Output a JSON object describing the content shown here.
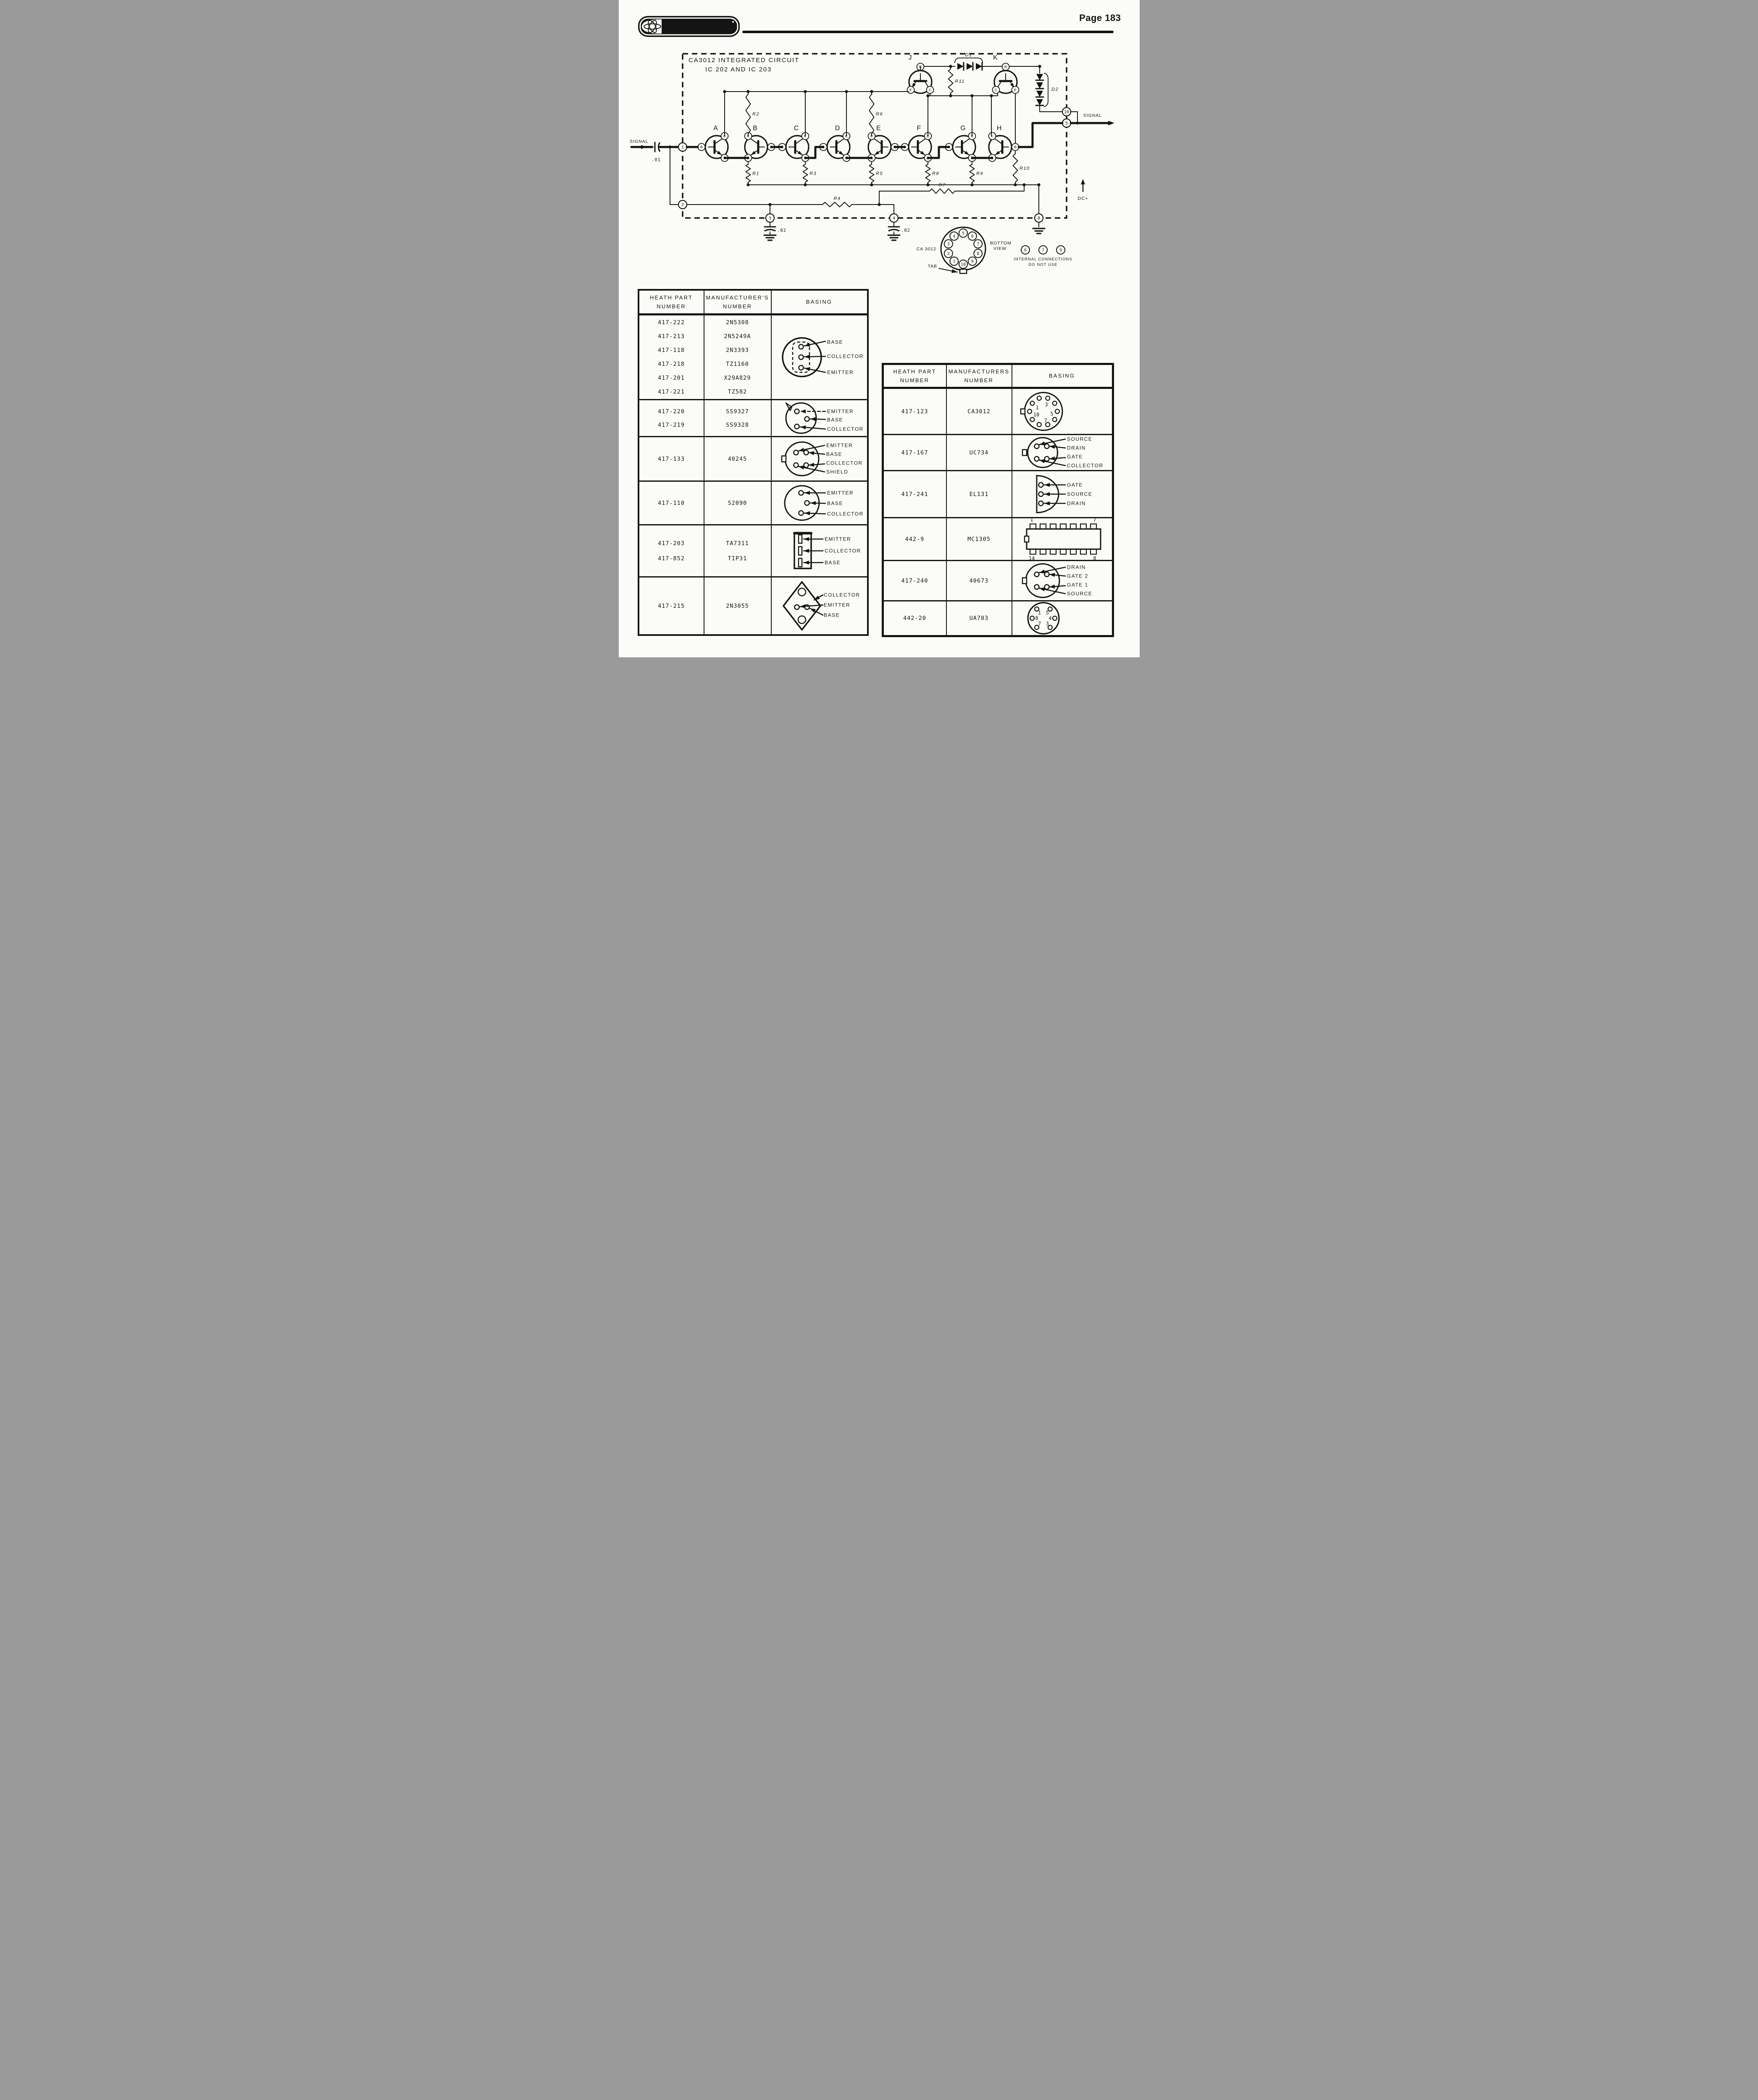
{
  "page": {
    "brand": "HEATHKIT",
    "number_label": "Page 183"
  },
  "schematic": {
    "title_line1": "CA3012 INTEGRATED CIRCUIT",
    "title_line2": "IC 202 AND IC 203",
    "signal_in": "SIGNAL",
    "signal_out": "SIGNAL",
    "input_cap": ".01",
    "cap_pin3": ".02",
    "cap_pin4": ".02",
    "dc_label": "DC+",
    "transistors": [
      "A",
      "B",
      "C",
      "D",
      "E",
      "F",
      "G",
      "H",
      "J",
      "K"
    ],
    "terminals": {
      "base": "B",
      "collector": "C",
      "emitter": "E"
    },
    "resistors": [
      "R1",
      "R2",
      "R3",
      "R4",
      "R5",
      "R6",
      "R7",
      "R8",
      "R9",
      "R10",
      "R11"
    ],
    "diodes": [
      "D1",
      "D2"
    ],
    "border_pins": [
      "1",
      "2",
      "3",
      "4",
      "5",
      "8",
      "10"
    ],
    "pinout": {
      "ic_label": "CA 3012",
      "view_line1": "BOTTOM",
      "view_line2": "VIEW",
      "tab_label": "TAB",
      "pins": [
        "1",
        "2",
        "3",
        "4",
        "5",
        "6",
        "7",
        "8",
        "9",
        "10"
      ],
      "internal_pins": [
        "6",
        "7",
        "9"
      ],
      "note_line1": "INTERNAL  CONNECTIONS",
      "note_line2": "DO NOT USE"
    }
  },
  "left_table": {
    "headers": [
      [
        "HEATH PART",
        "NUMBER"
      ],
      [
        "MANUFACTURER'S",
        "NUMBER"
      ],
      [
        "BASING"
      ]
    ],
    "rows": [
      {
        "parts": [
          [
            "417-222",
            "2N5308"
          ],
          [
            "417-213",
            "2N5249A"
          ],
          [
            "417-118",
            "2N3393"
          ],
          [
            "417-218",
            "TZ1160"
          ],
          [
            "417-201",
            "X29A829"
          ],
          [
            "417-221",
            "TZ582"
          ]
        ],
        "basing": {
          "type": "to92-dashed",
          "labels": [
            "BASE",
            "COLLECTOR",
            "EMITTER"
          ]
        }
      },
      {
        "parts": [
          [
            "417-220",
            "SS9327"
          ],
          [
            "417-219",
            "SS9328"
          ]
        ],
        "basing": {
          "type": "to92-tab",
          "labels": [
            "EMITTER",
            "BASE",
            "COLLECTOR"
          ]
        }
      },
      {
        "parts": [
          [
            "417-133",
            "40245"
          ]
        ],
        "basing": {
          "type": "to5-4pin",
          "labels": [
            "EMITTER",
            "BASE",
            "COLLECTOR",
            "SHIELD"
          ]
        }
      },
      {
        "parts": [
          [
            "417-110",
            "S2090"
          ]
        ],
        "basing": {
          "type": "to5-3pin",
          "labels": [
            "EMITTER",
            "BASE",
            "COLLECTOR"
          ]
        }
      },
      {
        "parts": [
          [
            "417-203",
            "TA7311"
          ],
          [
            "417-852",
            "TIP31"
          ]
        ],
        "basing": {
          "type": "power-tab",
          "labels": [
            "EMITTER",
            "COLLECTOR",
            "BASE"
          ]
        }
      },
      {
        "parts": [
          [
            "417-215",
            "2N3055"
          ]
        ],
        "basing": {
          "type": "to3",
          "labels": [
            "COLLECTOR",
            "EMITTER",
            "BASE"
          ]
        }
      }
    ]
  },
  "right_table": {
    "headers": [
      [
        "HEATH PART",
        "NUMBER"
      ],
      [
        "MANUFACTURERS",
        "NUMBER"
      ],
      [
        "BASING"
      ]
    ],
    "rows": [
      {
        "parts": [
          [
            "417-123",
            "CA3012"
          ]
        ],
        "basing": {
          "type": "to5-10pin",
          "labels": [
            "1",
            "3",
            "10",
            "5",
            "7"
          ]
        }
      },
      {
        "parts": [
          [
            "417-167",
            "UC734"
          ]
        ],
        "basing": {
          "type": "to5-4pin",
          "labels": [
            "SOURCE",
            "DRAIN",
            "GATE",
            "COLLECTOR"
          ]
        }
      },
      {
        "parts": [
          [
            "417-241",
            "EL131"
          ]
        ],
        "basing": {
          "type": "dshape-3pin",
          "labels": [
            "GATE",
            "SOURCE",
            "DRAIN"
          ]
        }
      },
      {
        "parts": [
          [
            "442-9",
            "MC1305"
          ]
        ],
        "basing": {
          "type": "dip14",
          "labels": [
            "1",
            "7",
            "14",
            "8"
          ]
        }
      },
      {
        "parts": [
          [
            "417-240",
            "40673"
          ]
        ],
        "basing": {
          "type": "to5-4pin",
          "labels": [
            "DRAIN",
            "GATE 2",
            "GATE 1",
            "SOURCE"
          ]
        }
      },
      {
        "parts": [
          [
            "442-20",
            "UA703"
          ]
        ],
        "basing": {
          "type": "to5-6pin",
          "labels": [
            "1",
            "5",
            "8",
            "4",
            "7",
            "3"
          ]
        }
      }
    ]
  }
}
